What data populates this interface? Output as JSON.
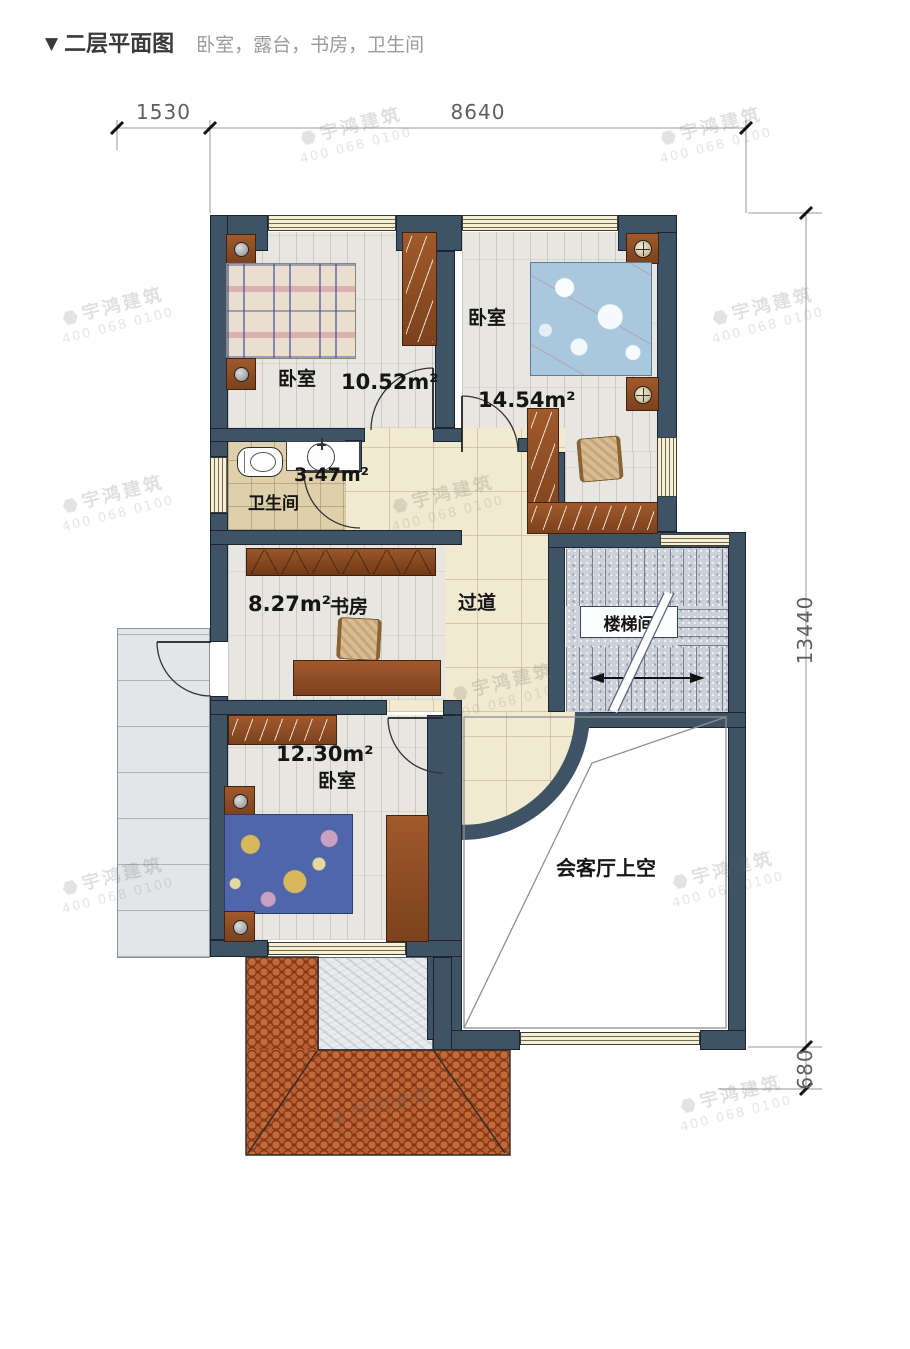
{
  "header": {
    "marker": "▼",
    "title": "二层平面图",
    "subtitle": "卧室，露台，书房，卫生间"
  },
  "dimensions": {
    "top_left": "1530",
    "top_right": "8640",
    "right_total": "13440",
    "bottom_right": "680"
  },
  "rooms": {
    "bedroom_top_left": {
      "name": "卧室",
      "area": "10.52m²"
    },
    "bedroom_top_right": {
      "name": "卧室",
      "area": "14.54m²"
    },
    "bathroom": {
      "name": "卫生间",
      "area": "3.47m²"
    },
    "study": {
      "name": "书房",
      "area": "8.27m²"
    },
    "hallway": {
      "name": "过道"
    },
    "stairwell": {
      "name": "楼梯间"
    },
    "bedroom_bottom": {
      "name": "卧室",
      "area": "12.30m²"
    },
    "living_void": {
      "name": "会客厅上空"
    }
  },
  "watermark": {
    "brand": "宇鸿建筑",
    "phone": "400 068 0100"
  },
  "colors": {
    "wall": "#3e5365",
    "window-fill": "#f7efcf",
    "floor-wood": "#e8e6e1",
    "floor-hall": "#f2ead0",
    "floor-bath": "#ddd0ab",
    "floor-terrace": "#e3e6e9",
    "floor-granite": "#ccd1d9",
    "marble": "#e9ebed",
    "roof": "#7e3413"
  }
}
